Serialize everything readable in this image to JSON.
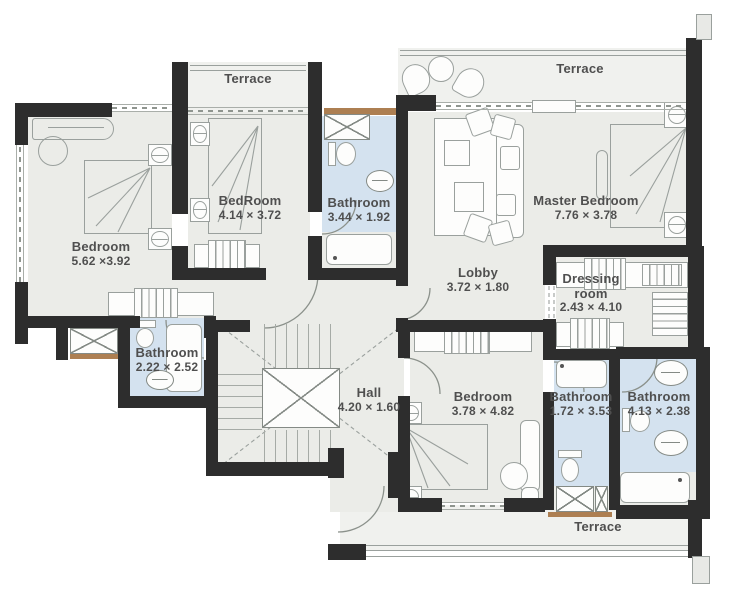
{
  "colors": {
    "wall": "#2d2d2d",
    "floor": "#ebece8",
    "terrace": "#f0f1ee",
    "bathroom": "#d4e2ef",
    "wood": "#ad7f52",
    "line": "#9aa09d",
    "text": "#4f4f4f"
  },
  "rooms": {
    "terrace_top_left": {
      "name": "Terrace"
    },
    "terrace_top_right": {
      "name": "Terrace"
    },
    "terrace_bottom": {
      "name": "Terrace"
    },
    "bedroom_left": {
      "name": "Bedroom",
      "dims": "5.62 ×3.92"
    },
    "bedroom_mid": {
      "name": "BedRoom",
      "dims": "4.14 × 3.72"
    },
    "bathroom_top": {
      "name": "Bathroom",
      "dims": "3.44 × 1.92"
    },
    "master_bedroom": {
      "name": "Master Bedroom",
      "dims": "7.76 × 3.78"
    },
    "lobby": {
      "name": "Lobby",
      "dims": "3.72 × 1.80"
    },
    "dressing_room": {
      "name": "Dressing room",
      "dims": "2.43 × 4.10"
    },
    "bathroom_mid_left": {
      "name": "Bathroom",
      "dims": "2.22 × 2.52"
    },
    "hall": {
      "name": "Hall",
      "dims": "4.20 × 1.60"
    },
    "bedroom_bottom": {
      "name": "Bedroom",
      "dims": "3.78 × 4.82"
    },
    "bathroom_bottom_mid": {
      "name": "Bathroom",
      "dims": "1.72 × 3.53"
    },
    "bathroom_bottom_right": {
      "name": "Bathroom",
      "dims": "4.13 × 2.38"
    }
  }
}
